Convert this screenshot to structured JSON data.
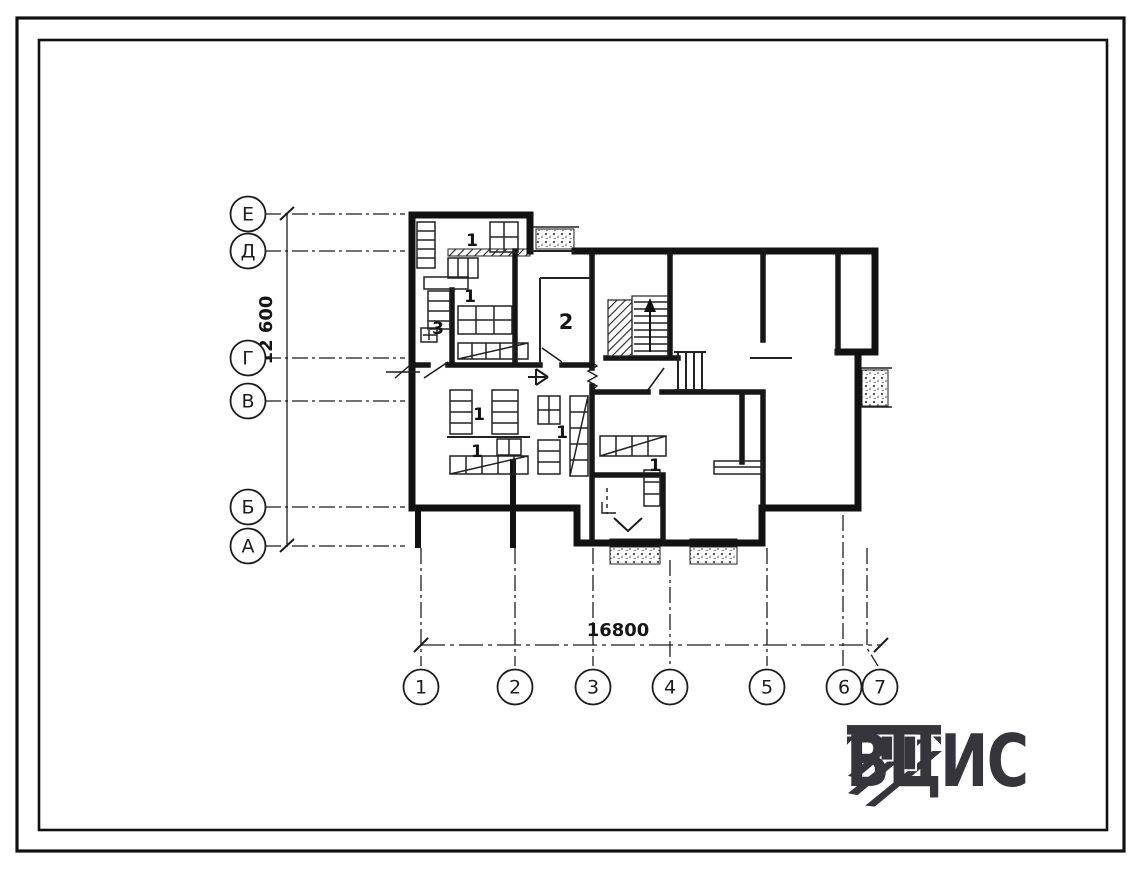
{
  "drawing": {
    "row_axes": [
      {
        "label": "Е",
        "y": 214
      },
      {
        "label": "Д",
        "y": 251
      },
      {
        "label": "Г",
        "y": 358
      },
      {
        "label": "В",
        "y": 401
      },
      {
        "label": "Б",
        "y": 507
      },
      {
        "label": "А",
        "y": 546
      }
    ],
    "col_axes": [
      {
        "label": "1",
        "x": 421,
        "line_from": 548,
        "bx": 421
      },
      {
        "label": "2",
        "x": 515,
        "line_from": 548,
        "bx": 515
      },
      {
        "label": "3",
        "x": 593,
        "line_from": 548,
        "bx": 593
      },
      {
        "label": "4",
        "x": 670,
        "line_from": 560,
        "bx": 670
      },
      {
        "label": "5",
        "x": 767,
        "line_from": 548,
        "bx": 767
      },
      {
        "label": "6",
        "x": 843,
        "line_from": 515,
        "bx": 844
      },
      {
        "label": "7",
        "x": 867,
        "line_from": 548,
        "bx": 880,
        "kink": true
      }
    ],
    "dimensions": {
      "vertical": "12 600",
      "horizontal": "16800"
    },
    "room_labels": [
      {
        "label": "1",
        "x": 472,
        "y": 246,
        "size": 17
      },
      {
        "label": "1",
        "x": 470,
        "y": 302,
        "size": 17
      },
      {
        "label": "3",
        "x": 438,
        "y": 334,
        "size": 17
      },
      {
        "label": "2",
        "x": 566,
        "y": 329,
        "size": 21
      },
      {
        "label": "1",
        "x": 479,
        "y": 420,
        "size": 17
      },
      {
        "label": "1",
        "x": 477,
        "y": 457,
        "size": 17
      },
      {
        "label": "1",
        "x": 562,
        "y": 438,
        "size": 17
      },
      {
        "label": "1",
        "x": 655,
        "y": 471,
        "size": 17
      }
    ],
    "logo": {
      "text": "ВЦИС"
    },
    "colors": {
      "ink": "#1c1c1c",
      "logo": "#35353b",
      "paper": "#ffffff"
    }
  }
}
